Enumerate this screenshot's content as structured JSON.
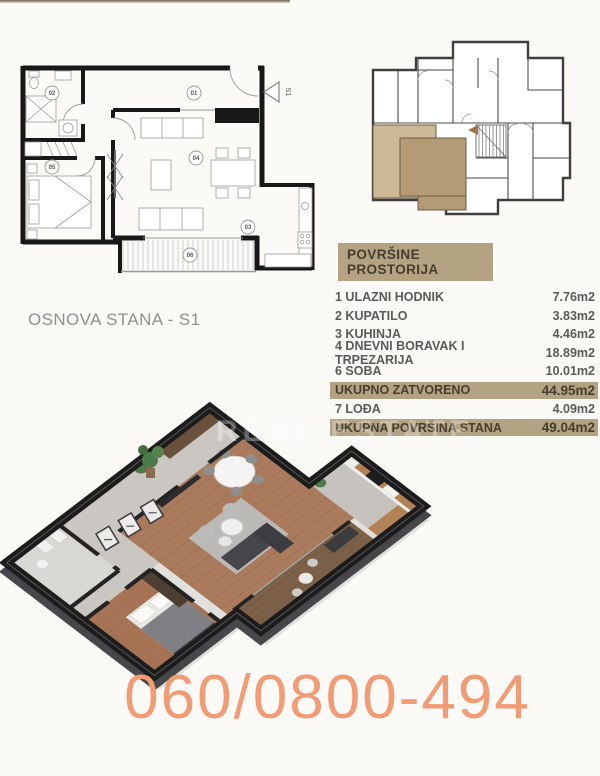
{
  "colors": {
    "bg": "#fbfaf7",
    "tan": "#b4a383",
    "tantext": "#453e2f",
    "rowtext": "#5a5a58",
    "phone": "#f29b75",
    "title": "#8f8f8f",
    "hl1": "#cdb897",
    "hl2": "#b59b75"
  },
  "plan2d": {
    "title": "OSNOVA STANA - S1",
    "entrance_label": "S1",
    "rooms": [
      "01",
      "02",
      "03",
      "04",
      "05",
      "06"
    ]
  },
  "area_table": {
    "header": "POVRŠINE PROSTORIJA",
    "rows": [
      {
        "num": "1",
        "label": "ULAZNI HODNIK",
        "value": "7.76m2",
        "highlight": false
      },
      {
        "num": "2",
        "label": "KUPATILO",
        "value": "3.83m2",
        "highlight": false
      },
      {
        "num": "3",
        "label": "KUHINJA",
        "value": "4.46m2",
        "highlight": false
      },
      {
        "num": "4",
        "label": "DNEVNI BORAVAK I TRPEZARIJA",
        "value": "18.89m2",
        "highlight": false
      },
      {
        "num": "6",
        "label": "SOBA",
        "value": "10.01m2",
        "highlight": false
      },
      {
        "num": "",
        "label": "UKUPNO ZATVORENO",
        "value": "44.95m2",
        "highlight": true
      },
      {
        "num": "7",
        "label": "LOĐA",
        "value": "4.09m2",
        "highlight": false
      },
      {
        "num": "",
        "label": "UKUPNA POVRŠINA STANA",
        "value": "49.04m2",
        "highlight": true
      }
    ]
  },
  "phone": "060/0800-494",
  "watermark": "REAL ESTATE"
}
